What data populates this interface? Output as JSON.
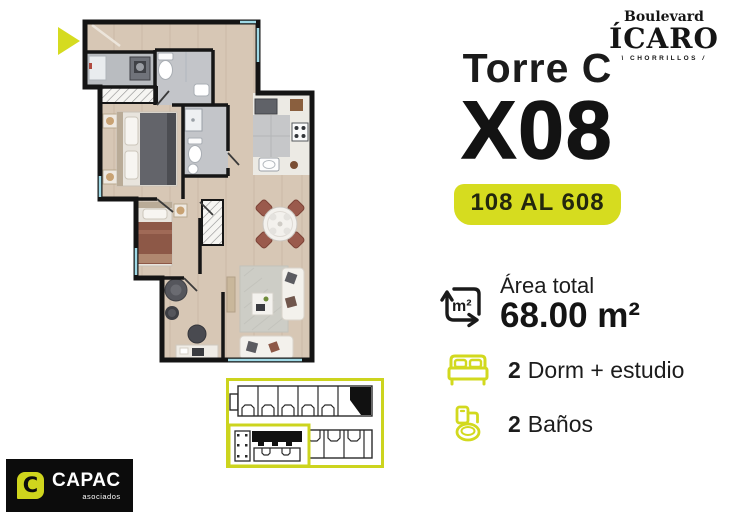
{
  "brand": {
    "line1": "Boulevard",
    "name": "ÍCARO",
    "district": "CHORRILLOS",
    "mark_left": "\\",
    "mark_right": "/"
  },
  "unit": {
    "tower": "Torre C",
    "number": "X08",
    "range": "108 AL 608"
  },
  "area": {
    "label": "Área total",
    "value": "68.00 m²",
    "icon": "area-m2-icon"
  },
  "features": [
    {
      "icon": "bed-icon",
      "count": "2",
      "label": "Dorm + estudio"
    },
    {
      "icon": "toilet-icon",
      "count": "2",
      "label": "Baños"
    }
  ],
  "footer_logo": {
    "initial": "C",
    "name": "CAPAC",
    "sub": "asociados"
  },
  "colors": {
    "accent": "#d5db20",
    "ink": "#1a1a1a",
    "window": "#9fd9e6",
    "wood": "#d7c7b5"
  }
}
